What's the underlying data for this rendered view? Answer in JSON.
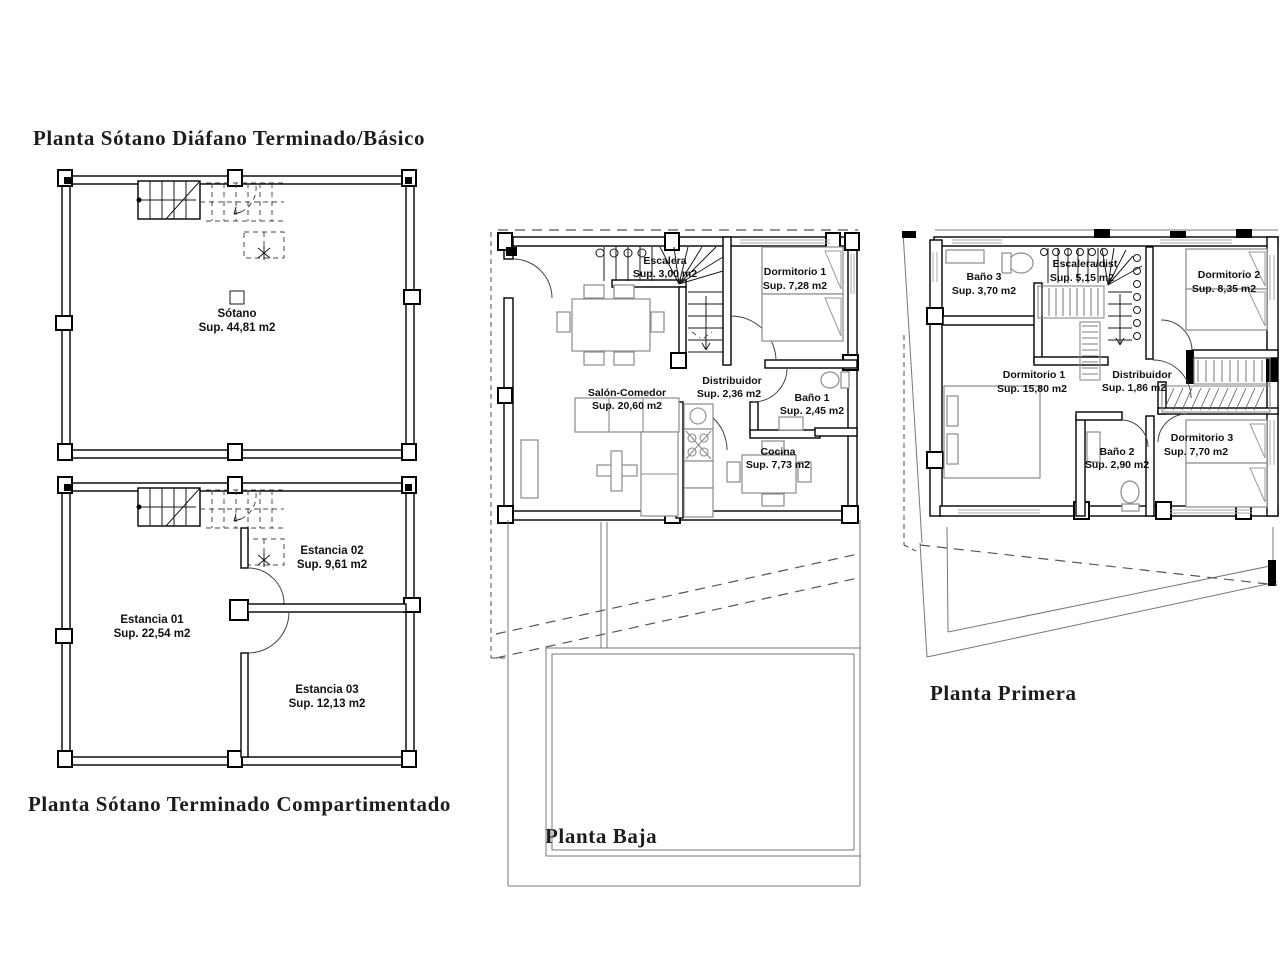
{
  "colors": {
    "background": "#ffffff",
    "wall_line": "#000000",
    "furniture_line": "#8a8a8a",
    "dashed_line": "#555555",
    "label_text": "#111111",
    "title_text": "#1c1c1c"
  },
  "plans": [
    {
      "id": "sotano-diafano",
      "title": "Planta Sótano Diáfano Terminado/Básico",
      "rooms": [
        {
          "name": "Sótano",
          "area": "Sup. 44,81 m2"
        }
      ]
    },
    {
      "id": "sotano-compartimentado",
      "title": "Planta Sótano Terminado Compartimentado",
      "rooms": [
        {
          "name": "Estancia 01",
          "area": "Sup. 22,54 m2"
        },
        {
          "name": "Estancia 02",
          "area": "Sup. 9,61 m2"
        },
        {
          "name": "Estancia 03",
          "area": "Sup. 12,13 m2"
        }
      ]
    },
    {
      "id": "planta-baja",
      "title": "Planta Baja",
      "rooms": [
        {
          "name": "Escalera",
          "area": "Sup. 3,00 m2"
        },
        {
          "name": "Dormitorio 1",
          "area": "Sup. 7,28 m2"
        },
        {
          "name": "Salón-Comedor",
          "area": "Sup. 20,60 m2"
        },
        {
          "name": "Distribuidor",
          "area": "Sup. 2,36 m2"
        },
        {
          "name": "Baño 1",
          "area": "Sup. 2,45 m2"
        },
        {
          "name": "Cocina",
          "area": "Sup. 7,73 m2"
        }
      ]
    },
    {
      "id": "planta-primera",
      "title": "Planta Primera",
      "rooms": [
        {
          "name": "Baño 3",
          "area": "Sup. 3,70 m2"
        },
        {
          "name": "Escalera/dist",
          "area": "Sup. 5,15 m2"
        },
        {
          "name": "Dormitorio 2",
          "area": "Sup. 8,35 m2"
        },
        {
          "name": "Dormitorio 1",
          "area": "Sup. 15,80 m2"
        },
        {
          "name": "Distribuidor",
          "area": "Sup. 1,86 m2"
        },
        {
          "name": "Baño 2",
          "area": "Sup. 2,90 m2"
        },
        {
          "name": "Dormitorio 3",
          "area": "Sup. 7,70 m2"
        }
      ]
    }
  ]
}
